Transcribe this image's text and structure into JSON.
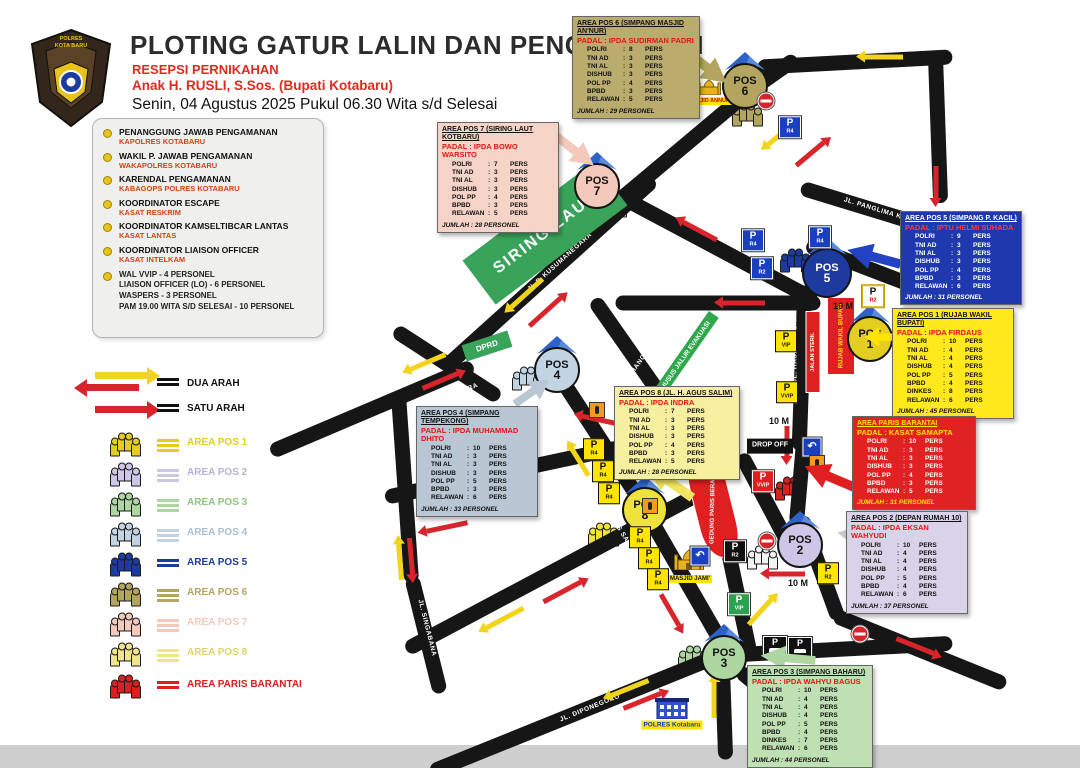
{
  "colon": ":",
  "pers_label": "PERS",
  "pos_label": "POS",
  "header": {
    "logo_line1": "POLRES",
    "logo_line2": "KOTA BARU",
    "title": "PLOTING GATUR LALIN DAN PENGAMANAN",
    "subtitle1": "RESEPSI PERNIKAHAN",
    "subtitle2": "Anak H. RUSLI, S.Sos. (Bupati Kotabaru)",
    "datetime": "Senin, 04 Agustus 2025 Pukul 06.30 Wita s/d Selesai"
  },
  "briefing": {
    "items": [
      {
        "role": "PENANGGUNG JAWAB PENGAMANAN",
        "officer": "KAPOLRES KOTABARU"
      },
      {
        "role": "WAKIL P. JAWAB PENGAMANAN",
        "officer": "WAKAPOLRES KOTABARU"
      },
      {
        "role": "KARENDAL PENGAMANAN",
        "officer": "KABAGOPS POLRES KOTABARU"
      },
      {
        "role": "KOORDINATOR ESCAPE",
        "officer": "KASAT RESKRIM"
      },
      {
        "role": "KOORDINATOR KAMSELTIBCAR LANTAS",
        "officer": "KASAT LANTAS"
      },
      {
        "role": "KOORDINATOR LIAISON OFFICER",
        "officer": "KASAT INTELKAM"
      }
    ],
    "footer_lines": [
      "WAL VVIP - 4 PERSONEL",
      "LIAISON OFFICER (LO) - 6 PERSONEL",
      "WASPERS - 3 PERSONEL",
      "PAM 19.00 WITA S/D SELESAI - 10 PERSONEL"
    ]
  },
  "legend": {
    "dua_arah": "DUA ARAH",
    "satu_arah": "SATU ARAH",
    "arrow_yellow": "#f2d51b",
    "arrow_red": "#d8252b",
    "areas": [
      {
        "label": "AREA POS 1",
        "color": "#e3cd20"
      },
      {
        "label": "AREA POS 2",
        "color": "#cdc6e6"
      },
      {
        "label": "AREA POS 3",
        "color": "#aed6a0"
      },
      {
        "label": "AREA POS 4",
        "color": "#c2d4e2"
      },
      {
        "label": "AREA POS 5",
        "color": "#1d3a9e"
      },
      {
        "label": "AREA POS 6",
        "color": "#b3a55f"
      },
      {
        "label": "AREA POS 7",
        "color": "#f2c9ba"
      },
      {
        "label": "AREA POS 8",
        "color": "#f0e48c"
      },
      {
        "label": "AREA PARIS BARANTAI",
        "color": "#d91f1f"
      }
    ]
  },
  "posts": [
    {
      "name": "AREA POS 6 (SIMPANG MASJID AN'NUR)",
      "padal": "PADAL : IPDA SUDIRMAN PADRI",
      "num": "6",
      "box_color": "#b9ac6d",
      "color": "#b3a55f",
      "total": "JUMLAH : 29 PERSONEL",
      "rows": [
        [
          "POLRI",
          "8"
        ],
        [
          "TNI AD",
          "3"
        ],
        [
          "TNI AL",
          "3"
        ],
        [
          "DISHUB",
          "3"
        ],
        [
          "POL PP",
          "4"
        ],
        [
          "BPBD",
          "3"
        ],
        [
          "RELAWAN",
          "5"
        ]
      ]
    },
    {
      "name": "AREA POS 7 (SIRING LAUT KOTBARU)",
      "padal": "PADAL : IPDA BOWO WARSITO",
      "num": "7",
      "box_color": "#f5d3c6",
      "color": "#f2c9ba",
      "total": "JUMLAH : 28 PERSONEL",
      "rows": [
        [
          "POLRI",
          "7"
        ],
        [
          "TNI AD",
          "3"
        ],
        [
          "TNI AL",
          "3"
        ],
        [
          "DISHUB",
          "3"
        ],
        [
          "POL PP",
          "4"
        ],
        [
          "BPBD",
          "3"
        ],
        [
          "RELAWAN",
          "5"
        ]
      ]
    },
    {
      "name": "AREA POS 5 (SIMPANG P. KACIL)",
      "padal": "PADAL : IPTU HELMI SUHADA",
      "num": "5",
      "box_color": "#2038ad",
      "color": "#1d3a9e",
      "total": "JUMLAH : 31 PERSONEL",
      "rows": [
        [
          "POLRI",
          "9"
        ],
        [
          "TNI AD",
          "3"
        ],
        [
          "TNI AL",
          "3"
        ],
        [
          "DISHUB",
          "3"
        ],
        [
          "POL PP",
          "4"
        ],
        [
          "BPBD",
          "3"
        ],
        [
          "RELAWAN",
          "6"
        ]
      ]
    },
    {
      "name": "AREA POS 1 (RUJAB WAKIL BUPATI)",
      "padal": "PADAL : IPDA FIRDAUS",
      "num": "1",
      "box_color": "#ffe81c",
      "color": "#e3cd20",
      "total": "JUMLAH : 45 PERSONEL",
      "rows": [
        [
          "POLRI",
          "10"
        ],
        [
          "TNI AD",
          "4"
        ],
        [
          "TNI AL",
          "4"
        ],
        [
          "DISHUB",
          "4"
        ],
        [
          "POL PP",
          "5"
        ],
        [
          "BPBD",
          "4"
        ],
        [
          "DINKES",
          "8"
        ],
        [
          "RELAWAN",
          "6"
        ]
      ]
    },
    {
      "name": "AREA PARIS BARANTAI",
      "padal": "PADAL : KASAT SAMAPTA",
      "num": "",
      "box_color": "#e02222",
      "color": "#d91f1f",
      "total": "JUMLAH : 31 PERSONEL",
      "rows": [
        [
          "POLRI",
          "10"
        ],
        [
          "TNI AD",
          "3"
        ],
        [
          "TNI AL",
          "3"
        ],
        [
          "DISHUB",
          "3"
        ],
        [
          "POL PP",
          "4"
        ],
        [
          "BPBD",
          "3"
        ],
        [
          "RELAWAN",
          "5"
        ]
      ]
    },
    {
      "name": "AREA POS 2 (DEPAN RUMAH 10)",
      "padal": "PADAL : IPDA EKSAN WAHYUDI",
      "num": "2",
      "box_color": "#d9d3ea",
      "color": "#cdc6e6",
      "total": "JUMLAH : 37 PERSONEL",
      "rows": [
        [
          "POLRI",
          "10"
        ],
        [
          "TNI AD",
          "4"
        ],
        [
          "TNI AL",
          "4"
        ],
        [
          "DISHUB",
          "4"
        ],
        [
          "POL PP",
          "5"
        ],
        [
          "BPBD",
          "4"
        ],
        [
          "RELAWAN",
          "6"
        ]
      ]
    },
    {
      "name": "AREA POS 3 (SIMPANG BAHARU)",
      "padal": "PADAL : IPDA WAHYU BAGUS",
      "num": "3",
      "box_color": "#bfe0b2",
      "color": "#aed6a0",
      "total": "JUMLAH : 44 PERSONEL",
      "rows": [
        [
          "POLRI",
          "10"
        ],
        [
          "TNI AD",
          "4"
        ],
        [
          "TNI AL",
          "4"
        ],
        [
          "DISHUB",
          "4"
        ],
        [
          "POL PP",
          "5"
        ],
        [
          "BPBD",
          "4"
        ],
        [
          "DINKES",
          "7"
        ],
        [
          "RELAWAN",
          "6"
        ]
      ]
    },
    {
      "name": "AREA POS 4 (SIMPANG TEMPEKONG)",
      "padal": "PADAL : IPDA MUHAMMAD DHITO",
      "num": "4",
      "box_color": "#b9c7d5",
      "color": "#c2d4e2",
      "total": "JUMLAH : 33 PERSONEL",
      "rows": [
        [
          "POLRI",
          "10"
        ],
        [
          "TNI AD",
          "3"
        ],
        [
          "TNI AL",
          "3"
        ],
        [
          "DISHUB",
          "3"
        ],
        [
          "POL PP",
          "5"
        ],
        [
          "BPBD",
          "3"
        ],
        [
          "RELAWAN",
          "6"
        ]
      ]
    },
    {
      "name": "AREA POS 8 (JL. H. AGUS SALIM)",
      "padal": "PADAL : IPDA INDRA",
      "num": "8",
      "box_color": "#f6efa0",
      "color": "#efe23a",
      "total": "JUMLAH : 28 PERSONEL",
      "rows": [
        [
          "POLRI",
          "7"
        ],
        [
          "TNI AD",
          "3"
        ],
        [
          "TNI AL",
          "3"
        ],
        [
          "DISHUB",
          "3"
        ],
        [
          "POL PP",
          "4"
        ],
        [
          "BPBD",
          "3"
        ],
        [
          "RELAWAN",
          "5"
        ]
      ]
    }
  ],
  "map": {
    "streets": {
      "kusumanegara": "JL.P. KUSUMANEGARA",
      "pattimura": "JL. PATTIMURA",
      "panglima_kacil": "JL. PANGLIMA KACIL",
      "sisingamangaraja": "JL. SISINGAMANGARAJA",
      "hasan_basri": "JL. HASAN BASRI",
      "agus_salim": "JL. AGUS SALIM",
      "suryagandamana": "JL. SURYAGANDAMANA",
      "patmaraga": "JL. PATMARAGA",
      "singabana": "JL. SINGABANA",
      "diponegoro": "JL. DIPONEGORO"
    },
    "labels": {
      "siring_laut": "SIRING LAUT",
      "dprd": "DPRD",
      "masjid_annur": "MASJID ANNUR",
      "masjid_jami": "MASJID JAMI'",
      "polres": "POLRES Kotabaru",
      "gedung_paris": "GEDUNG PARIS BERANTAI",
      "rujab": "RUJAB WAKIL BUPATI",
      "drop_off": "DROP OFF",
      "jalan_steril": "JALAN STERIL",
      "jalur_evakuasi": "KHUSUS JALUR EVAKUASI",
      "dist_10m": "10 M"
    },
    "sign_labels": {
      "p": "P",
      "r2": "R2",
      "r4": "R4",
      "vip": "VIP",
      "vvip": "VVIP",
      "uturn": "↶"
    },
    "colors": {
      "road": "#161616",
      "green": "#3aa35a",
      "arrow_yellow": "#f2d51b",
      "arrow_red": "#d8252b"
    }
  }
}
